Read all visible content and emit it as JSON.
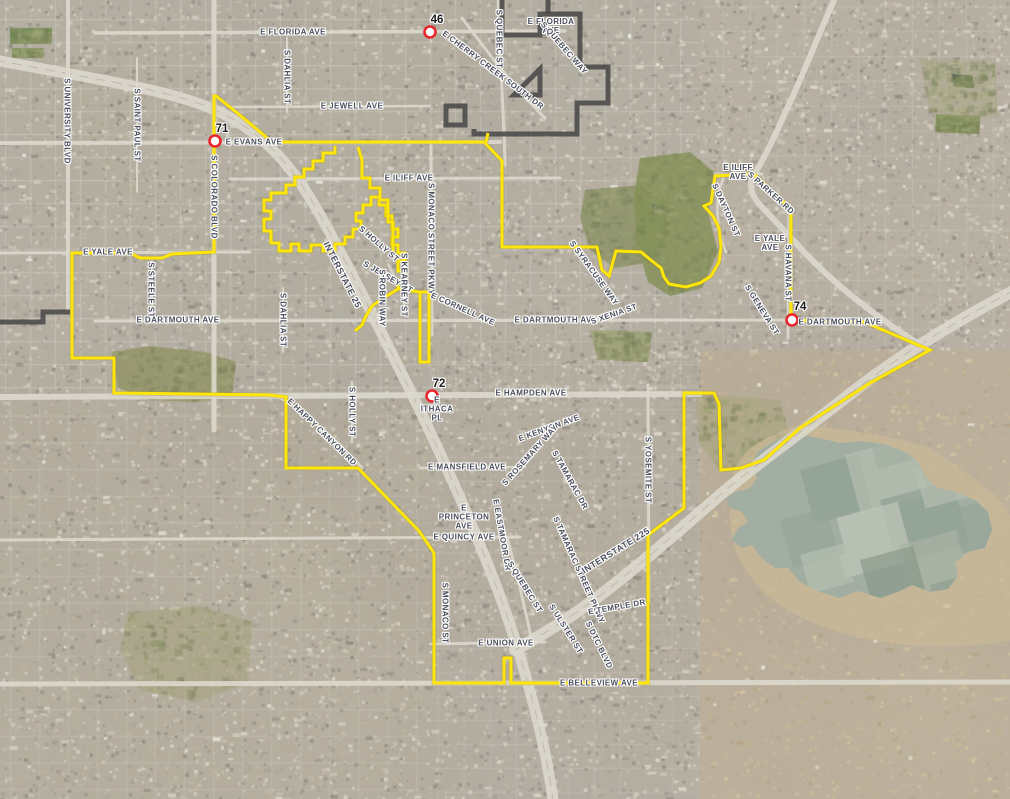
{
  "map": {
    "colors": {
      "boundary_yellow": "#ffe60a",
      "boundary_yellow_halo": "#8a7a00",
      "boundary_dark": "#454545",
      "marker_ring": "#e8262b",
      "marker_fill": "#ffffff",
      "road": "#dcd8cd",
      "lake_water": "#a2aea1",
      "lake_shore": "#cbb997",
      "label_text": "#4b4f5c"
    },
    "markers": [
      {
        "num": "46",
        "x": 430,
        "y": 32,
        "lx": 437,
        "ly": 20
      },
      {
        "num": "71",
        "x": 215,
        "y": 141,
        "lx": 222,
        "ly": 129
      },
      {
        "num": "72",
        "x": 432,
        "y": 396,
        "lx": 439,
        "ly": 384
      },
      {
        "num": "74",
        "x": 792,
        "y": 320,
        "lx": 800,
        "ly": 307
      }
    ],
    "street_labels": [
      {
        "t": "E FLORIDA AVE",
        "x": 293,
        "y": 32,
        "r": 0
      },
      {
        "lines": [
          "E FLORIDA",
          "AVE"
        ],
        "x": 551,
        "y": 26,
        "r": 0
      },
      {
        "t": "E CHERRY CREEK SOUTH DR",
        "x": 493,
        "y": 70,
        "r": 37
      },
      {
        "t": "S QUEBEC ST",
        "x": 499,
        "y": 39,
        "r": 90
      },
      {
        "t": "S QUEBEC WAY",
        "x": 564,
        "y": 48,
        "r": 49
      },
      {
        "t": "E JEWELL AVE",
        "x": 352,
        "y": 106,
        "r": 0
      },
      {
        "t": "S DAHLIA ST",
        "x": 287,
        "y": 77,
        "r": 90
      },
      {
        "t": "S UNIVERSITY BLVD",
        "x": 67,
        "y": 121,
        "r": 90
      },
      {
        "t": "S SAINT PAUL ST",
        "x": 137,
        "y": 125,
        "r": 90
      },
      {
        "t": "E EVANS AVE",
        "x": 254,
        "y": 142,
        "r": 0
      },
      {
        "t": "S COLORADO BLVD",
        "x": 214,
        "y": 197,
        "r": 90
      },
      {
        "t": "E ILIFF AVE",
        "x": 409,
        "y": 178,
        "r": 0
      },
      {
        "lines": [
          "E ILIFF",
          "AVE"
        ],
        "x": 738,
        "y": 172,
        "r": 0
      },
      {
        "t": "S PARKER RD",
        "x": 771,
        "y": 193,
        "r": 42
      },
      {
        "t": "S DAYTON ST",
        "x": 726,
        "y": 210,
        "r": 66
      },
      {
        "lines": [
          "E YALE",
          "AVE"
        ],
        "x": 770,
        "y": 243,
        "r": 0
      },
      {
        "t": "S HAVANA ST",
        "x": 788,
        "y": 273,
        "r": 90
      },
      {
        "t": "S MONACO STREET PKWY",
        "x": 431,
        "y": 239,
        "r": 90
      },
      {
        "t": "INTERSTATE 25",
        "x": 342,
        "y": 275,
        "r": 63,
        "fs": 9
      },
      {
        "t": "S HOLLY ST",
        "x": 379,
        "y": 244,
        "r": 41
      },
      {
        "t": "S JERSEY ST",
        "x": 388,
        "y": 277,
        "r": 30
      },
      {
        "t": "S ROBIN WAY",
        "x": 382,
        "y": 298,
        "r": 90
      },
      {
        "t": "S KEARNEY ST",
        "x": 404,
        "y": 285,
        "r": 90
      },
      {
        "t": "E CORNELL AVE",
        "x": 463,
        "y": 309,
        "r": 24
      },
      {
        "t": "S SYRACUSE WAY",
        "x": 594,
        "y": 273,
        "r": 54
      },
      {
        "t": "E YALE AVE",
        "x": 108,
        "y": 252,
        "r": 0
      },
      {
        "t": "S STEELE ST",
        "x": 151,
        "y": 290,
        "r": 90
      },
      {
        "t": "E DARTMOUTH AVE",
        "x": 178,
        "y": 320,
        "r": 0
      },
      {
        "t": "S DAHLIA ST",
        "x": 283,
        "y": 320,
        "r": 90
      },
      {
        "t": "E DARTMOUTH AVE",
        "x": 556,
        "y": 320,
        "r": 0
      },
      {
        "t": "S XENIA ST",
        "x": 614,
        "y": 314,
        "r": -19
      },
      {
        "t": "E DARTMOUTH AVE",
        "x": 840,
        "y": 322,
        "r": 0
      },
      {
        "t": "S GENEVA ST",
        "x": 762,
        "y": 310,
        "r": 58
      },
      {
        "t": "E HAMPDEN AVE",
        "x": 531,
        "y": 393,
        "r": 0
      },
      {
        "t": "E HAPPY CANYON RD",
        "x": 322,
        "y": 432,
        "r": 44
      },
      {
        "t": "S HOLLY ST",
        "x": 352,
        "y": 412,
        "r": 90
      },
      {
        "t": "E MANSFIELD AVE",
        "x": 467,
        "y": 467,
        "r": 0
      },
      {
        "t": "E KENYON AVE",
        "x": 549,
        "y": 428,
        "r": -20
      },
      {
        "t": "S ROSEMARY WAY",
        "x": 530,
        "y": 455,
        "r": -48
      },
      {
        "t": "S TAMARAC DR",
        "x": 570,
        "y": 480,
        "r": 61
      },
      {
        "t": "S YOSEMITE ST",
        "x": 648,
        "y": 470,
        "r": 90
      },
      {
        "lines": [
          "E",
          "PRINCETON",
          "AVE"
        ],
        "x": 464,
        "y": 517,
        "r": 0
      },
      {
        "t": "E QUINCY AVE",
        "x": 464,
        "y": 537,
        "r": 0
      },
      {
        "t": "E EASTMOOR DR",
        "x": 502,
        "y": 535,
        "r": 80
      },
      {
        "t": "S QUEBEC ST",
        "x": 525,
        "y": 587,
        "r": 58
      },
      {
        "t": "S TAMARAC STREET PKWY",
        "x": 579,
        "y": 570,
        "r": 66
      },
      {
        "t": "INTERSTATE 225",
        "x": 616,
        "y": 551,
        "r": -32,
        "fs": 9
      },
      {
        "t": "S MONACO ST",
        "x": 445,
        "y": 613,
        "r": 90
      },
      {
        "t": "E UNION AVE",
        "x": 506,
        "y": 643,
        "r": 0
      },
      {
        "t": "E TEMPLE DR",
        "x": 617,
        "y": 607,
        "r": -10
      },
      {
        "t": "S ULSTER ST",
        "x": 566,
        "y": 629,
        "r": 58
      },
      {
        "t": "S DTC BLVD",
        "x": 599,
        "y": 645,
        "r": 64
      },
      {
        "t": "E BELLEVIEW AVE",
        "x": 599,
        "y": 683,
        "r": 0
      },
      {
        "lines": [
          "E",
          "ITHACA",
          "PL"
        ],
        "x": 437,
        "y": 409,
        "r": 0
      }
    ],
    "boundary_yellow_paths": [
      "M216 96 C230 107 258 130 272 142 L484 142 L502 161 L502 247 L597 247 L602 270 L609 276 L616 251 L641 252 L652 261 L661 268 L664 277 L669 284 L686 287 L700 283 L711 276 L719 262 L721 247 L719 228 L713 216 L704 206 L711 203 L715 176 L754 174 L791 209 L791 320 L864 322 L930 350 L870 383 L800 428 L764 460 L741 468 L721 470 L719 404 L714 393 L684 393 L684 508 L648 535 L648 683 L511 683 L511 658 L504 658 L504 683 L434 683 L434 553 L419 531 L358 468 L286 468 L286 397 L270 395 L114 393 L114 358 L72 358 L72 253 L130 253 L140 258 L162 258 L172 254 L214 252 L214 96 Z",
      "M335 146 L335 153 L323 153 L323 161 L313 161 L313 169 L304 169 L304 177 L295 177 L295 185 L286 185 L286 193 L271 193 L271 200 L264 200 L264 211 L271 211 L271 219 L264 219 L264 231 L271 231 L271 243 L279 243 L279 251 L291 251 L291 244 L299 244 L299 251 L311 251 L311 245 L323 245 L323 251 L335 251 L335 244 L345 244 L345 237 L353 237 L353 229 L361 229 L361 221 L356 221 L356 213 L363 213 L363 205 L371 205 L371 197 L379 197 L379 205 L386 205 L386 216 L392 216 L392 229 L398 229 L398 237 L392 237 L392 245 L398 245 L398 253 L405 253 L405 261 L398 261 L398 271 L405 271 L405 281 L398 281 L398 289 L420 292 L420 362 L429 362 L429 292 L420 292",
      "M358 147 L362 160 L362 178 L370 178 L370 188 L380 188 L380 200 L388 200 L388 222 L393 222 L393 253",
      "M398 289 L385 297 L372 306 L366 316 L362 325 L355 331",
      "M488 133 L486 142"
    ],
    "boundary_dark_paths": [
      "M502 -3 L502 35 L540 35 L540 14 L580 14 L580 67 L608 67 L608 103 L577 103 L577 134 L474 134 L474 129",
      "M514 95 L540 69 L540 95 Z",
      "M446 106 L465 106 L465 125 L446 125 Z",
      "M-3 322 L43 322 L43 312 L70 312",
      "M548 -3 L548 13"
    ],
    "roads": [
      {
        "d": "M-5 60 C100 80 170 90 215 110 C265 132 295 170 320 215 C350 268 380 330 410 390 C445 462 480 540 505 610 C525 668 545 740 553 800",
        "w": 11
      },
      {
        "d": "M1015 290 C950 324 890 362 845 398 C795 437 755 465 720 495 C683 527 640 565 598 597 C570 618 540 636 515 650",
        "w": 12
      },
      {
        "d": "M836 -5 L800 80 C780 125 765 158 753 176 C748 185 752 196 760 205 L795 242 C830 282 880 320 928 350",
        "w": 6
      },
      {
        "d": "M-5 397 L700 394",
        "w": 6
      },
      {
        "d": "M-5 143 L500 142",
        "w": 4
      },
      {
        "d": "M230 179 L560 178",
        "w": 3
      },
      {
        "d": "M715 174 L762 174",
        "w": 3
      },
      {
        "d": "M95 33 L565 31",
        "w": 3.5
      },
      {
        "d": "M230 107 L430 106",
        "w": 2.5
      },
      {
        "d": "M-5 253 L250 252",
        "w": 3
      },
      {
        "d": "M95 321 L880 320",
        "w": 3
      },
      {
        "d": "M-5 684 L1015 682",
        "w": 5
      },
      {
        "d": "M-5 540 L520 537",
        "w": 3
      },
      {
        "d": "M430 644 L545 642",
        "w": 3
      },
      {
        "d": "M420 468 L525 467",
        "w": 2.5
      },
      {
        "d": "M214 -5 L214 430",
        "w": 5
      },
      {
        "d": "M68 -5 L68 310",
        "w": 4
      },
      {
        "d": "M431 145 L432 335",
        "w": 3
      },
      {
        "d": "M498 -5 C500 60 504 120 505 165",
        "w": 3
      },
      {
        "d": "M508 540 C516 572 524 602 532 642",
        "w": 3
      },
      {
        "d": "M789 205 L788 338",
        "w": 3
      },
      {
        "d": "M648 385 L649 600",
        "w": 3
      },
      {
        "d": "M724 176 C714 200 716 228 726 252",
        "w": 2.5
      },
      {
        "d": "M352 382 L352 442",
        "w": 2.5
      },
      {
        "d": "M287 38 L287 112",
        "w": 2
      },
      {
        "d": "M283 288 L283 352",
        "w": 2
      },
      {
        "d": "M137 58 L137 192",
        "w": 2
      },
      {
        "d": "M152 262 L152 318",
        "w": 2
      },
      {
        "d": "M280 398 C310 415 340 445 362 468",
        "w": 3
      },
      {
        "d": "M462 18 C492 58 518 92 545 118",
        "w": 3
      },
      {
        "d": "M404 258 L404 312",
        "w": 2
      },
      {
        "d": "M388 264 L402 292",
        "w": 2
      }
    ],
    "lake": {
      "shore_d": "M735 470 C745 448 760 438 800 425 C860 430 905 440 930 448 C960 470 1000 490 1012 520 L1012 640 C960 650 900 648 850 635 C800 622 760 600 740 560 C728 535 726 500 735 470 Z",
      "water_d": "M757 452 L780 438 L810 436 L840 443 L862 441 L886 445 L905 452 L918 462 L926 478 L938 488 L955 492 L975 500 L988 512 L992 530 L985 548 L968 552 L955 563 L958 576 L948 589 L930 592 L912 585 L900 591 L880 598 L858 591 L840 598 L820 592 L800 582 L788 568 L775 568 L762 558 L752 545 L742 548 L732 540 L738 528 L748 522 L742 512 L730 508 L726 498 L735 492 L750 488 L757 478 L752 466 Z",
      "patches": [
        {
          "x": 800,
          "y": 470,
          "w": 60,
          "h": 55,
          "f": "#8e9e92"
        },
        {
          "x": 845,
          "y": 455,
          "w": 70,
          "h": 60,
          "f": "#b7c0b2"
        },
        {
          "x": 880,
          "y": 500,
          "w": 75,
          "h": 65,
          "f": "#8e9e92"
        },
        {
          "x": 830,
          "y": 520,
          "w": 70,
          "h": 60,
          "f": "#c3cabb"
        },
        {
          "x": 780,
          "y": 520,
          "w": 55,
          "h": 50,
          "f": "#95a498"
        },
        {
          "x": 900,
          "y": 545,
          "w": 60,
          "h": 55,
          "f": "#aab4a5"
        },
        {
          "x": 860,
          "y": 560,
          "w": 55,
          "h": 45,
          "f": "#879789"
        },
        {
          "x": 915,
          "y": 470,
          "w": 45,
          "h": 40,
          "f": "#b7c0b2"
        },
        {
          "x": 950,
          "y": 510,
          "w": 45,
          "h": 45,
          "f": "#95a498"
        },
        {
          "x": 800,
          "y": 555,
          "w": 45,
          "h": 40,
          "f": "#b7c0b2"
        },
        {
          "x": 870,
          "y": 440,
          "w": 40,
          "h": 30,
          "f": "#9fae9f"
        },
        {
          "x": 930,
          "y": 585,
          "w": 40,
          "h": 25,
          "f": "#8e9e92"
        }
      ]
    },
    "areas": [
      {
        "name": "golf-wellshire",
        "fill": "#939467",
        "a": 0.85,
        "pts": [
          [
            112,
            352
          ],
          [
            150,
            346
          ],
          [
            205,
            352
          ],
          [
            236,
            362
          ],
          [
            232,
            396
          ],
          [
            196,
            402
          ],
          [
            150,
            400
          ],
          [
            118,
            388
          ]
        ]
      },
      {
        "name": "park-center-green",
        "fill": "#8b9164",
        "a": 0.8,
        "pts": [
          [
            585,
            190
          ],
          [
            640,
            185
          ],
          [
            665,
            200
          ],
          [
            668,
            235
          ],
          [
            650,
            262
          ],
          [
            615,
            268
          ],
          [
            590,
            250
          ],
          [
            580,
            218
          ]
        ]
      },
      {
        "name": "golf-kennedy",
        "fill": "#859058",
        "a": 0.85,
        "pts": [
          [
            640,
            158
          ],
          [
            690,
            152
          ],
          [
            714,
            172
          ],
          [
            708,
            212
          ],
          [
            718,
            252
          ],
          [
            702,
            288
          ],
          [
            670,
            296
          ],
          [
            648,
            282
          ],
          [
            636,
            242
          ],
          [
            634,
            196
          ]
        ]
      },
      {
        "name": "park-bible",
        "fill": "#9aa06f",
        "a": 0.7,
        "pts": [
          [
            590,
            330
          ],
          [
            652,
            332
          ],
          [
            648,
            362
          ],
          [
            598,
            360
          ]
        ]
      },
      {
        "name": "open-hampden",
        "fill": "#a8a47c",
        "a": 0.55,
        "pts": [
          [
            696,
            394
          ],
          [
            780,
            400
          ],
          [
            792,
            444
          ],
          [
            762,
            466
          ],
          [
            718,
            468
          ],
          [
            698,
            440
          ]
        ]
      },
      {
        "name": "park-sw",
        "fill": "#a39f7a",
        "a": 0.5,
        "pts": [
          [
            128,
            612
          ],
          [
            200,
            606
          ],
          [
            252,
            622
          ],
          [
            248,
            682
          ],
          [
            196,
            702
          ],
          [
            140,
            690
          ],
          [
            120,
            650
          ]
        ]
      },
      {
        "name": "field-stadium-1",
        "fill": "#6f9150",
        "a": 0.9,
        "pts": [
          [
            10,
            28
          ],
          [
            52,
            28
          ],
          [
            52,
            44
          ],
          [
            10,
            44
          ]
        ]
      },
      {
        "name": "field-stadium-2",
        "fill": "#7a9a58",
        "a": 0.9,
        "pts": [
          [
            12,
            48
          ],
          [
            44,
            48
          ],
          [
            44,
            58
          ],
          [
            12,
            58
          ]
        ]
      },
      {
        "name": "field-school-ne",
        "fill": "#7f9455",
        "a": 0.9,
        "pts": [
          [
            936,
            114
          ],
          [
            980,
            116
          ],
          [
            979,
            134
          ],
          [
            935,
            132
          ]
        ]
      },
      {
        "name": "park-ne",
        "fill": "#a5a47e",
        "a": 0.4,
        "pts": [
          [
            920,
            58
          ],
          [
            995,
            62
          ],
          [
            998,
            118
          ],
          [
            930,
            112
          ]
        ]
      },
      {
        "name": "pond-1",
        "fill": "#5f6b5a",
        "a": 0.9,
        "pts": [
          [
            652,
            204
          ],
          [
            664,
            206
          ],
          [
            666,
            214
          ],
          [
            654,
            214
          ]
        ]
      },
      {
        "name": "pond-ne",
        "fill": "#55605a",
        "a": 0.9,
        "pts": [
          [
            952,
            74
          ],
          [
            972,
            76
          ],
          [
            974,
            88
          ],
          [
            954,
            86
          ]
        ]
      }
    ]
  }
}
